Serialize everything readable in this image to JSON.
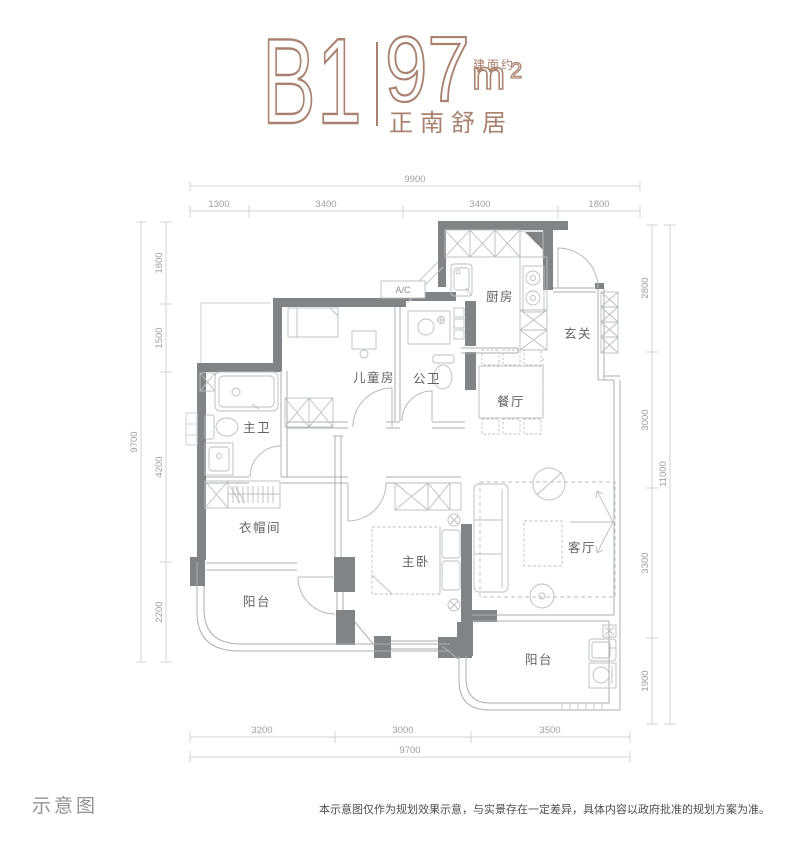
{
  "header": {
    "unit_code": "B1",
    "area_value": "97",
    "area_prefix": "建面约",
    "area_unit": "m",
    "area_exponent": "2",
    "tagline": "正南舒居",
    "accent_color": "#a8816f"
  },
  "floorplan": {
    "rooms": {
      "kitchen": "厨房",
      "entry": "玄关",
      "dining": "餐厅",
      "kids_room": "儿童房",
      "guest_bath": "公卫",
      "master_bath": "主卫",
      "cloakroom": "衣帽间",
      "balcony_left": "阳台",
      "master_bedroom": "主卧",
      "living": "客厅",
      "balcony_bottom": "阳台",
      "ac_unit": "A/C"
    },
    "dimensions": {
      "top": {
        "total": "9900",
        "segments": [
          "1300",
          "3400",
          "3400",
          "1800"
        ]
      },
      "left": {
        "total": "9700",
        "segments": [
          "1800",
          "1500",
          "4200",
          "2200"
        ]
      },
      "right": {
        "total": "11000",
        "segments": [
          "2800",
          "3000",
          "3300",
          "1900"
        ]
      },
      "bottom": {
        "total": "9700",
        "segments": [
          "3200",
          "3000",
          "3500"
        ]
      }
    },
    "wall_color": "#818486",
    "line_color": "#a9aeb2"
  },
  "footer": {
    "caption": "示意图",
    "disclaimer": "本示意图仅作为规划效果示意，与实景存在一定差异，具体内容以政府批准的规划方案为准。"
  }
}
